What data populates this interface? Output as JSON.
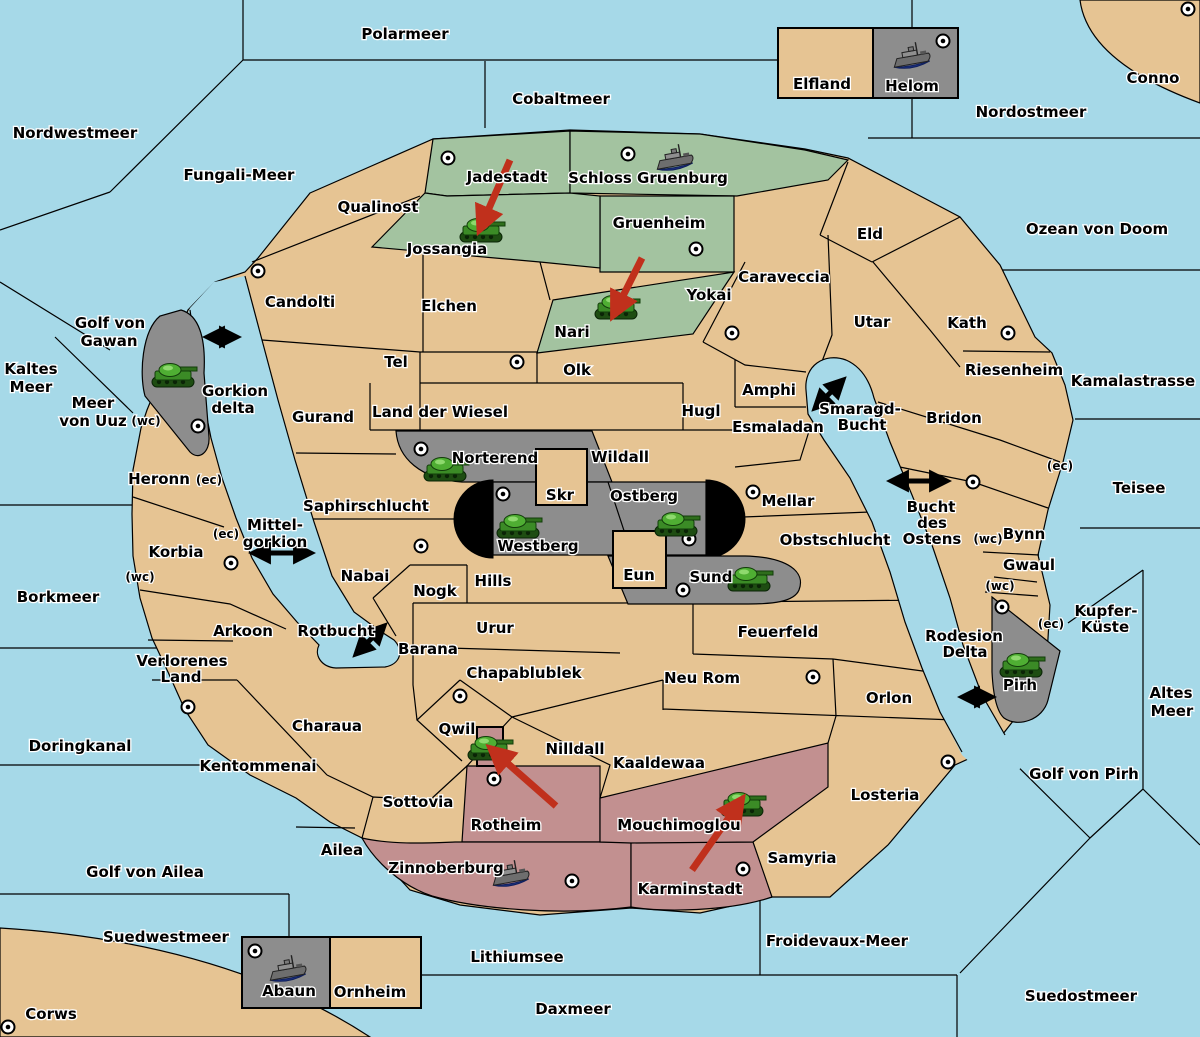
{
  "colors": {
    "sea": "#A6D9E8",
    "land": "#E6C493",
    "green": "#A3C3A0",
    "gray": "#8D8D8D",
    "pink": "#C29090",
    "mountain_black": "#000000",
    "attack_arrow_red": "#C0301C",
    "border": "#000000"
  },
  "sea_labels": [
    {
      "text": "Polarmeer",
      "x": 405,
      "y": 39
    },
    {
      "text": "Cobaltmeer",
      "x": 561,
      "y": 104
    },
    {
      "text": "Nordwestmeer",
      "x": 75,
      "y": 138
    },
    {
      "text": "Fungali-Meer",
      "x": 239,
      "y": 180
    },
    {
      "text": "Nordostmeer",
      "x": 1031,
      "y": 117
    },
    {
      "text": "Ozean von Doom",
      "x": 1097,
      "y": 234
    },
    {
      "text": "Kamalastrasse",
      "x": 1133,
      "y": 386
    },
    {
      "text": "Kaltes",
      "x": 31,
      "y": 374
    },
    {
      "text": "Meer",
      "x": 31,
      "y": 392
    },
    {
      "text": "Golf von",
      "x": 110,
      "y": 328
    },
    {
      "text": "Gawan",
      "x": 109,
      "y": 346
    },
    {
      "text": "Meer",
      "x": 93,
      "y": 408
    },
    {
      "text": "von Uuz",
      "x": 93,
      "y": 426
    },
    {
      "text": "Gorkion",
      "x": 235,
      "y": 396
    },
    {
      "text": "delta",
      "x": 233,
      "y": 413
    },
    {
      "text": "Mittel-",
      "x": 275,
      "y": 530
    },
    {
      "text": "gorkion",
      "x": 275,
      "y": 547
    },
    {
      "text": "Borkmeer",
      "x": 58,
      "y": 602
    },
    {
      "text": "Doringkanal",
      "x": 80,
      "y": 751
    },
    {
      "text": "Golf von Ailea",
      "x": 145,
      "y": 877
    },
    {
      "text": "Suedwestmeer",
      "x": 166,
      "y": 942
    },
    {
      "text": "Corws",
      "x": 51,
      "y": 1019
    },
    {
      "text": "Lithiumsee",
      "x": 517,
      "y": 962
    },
    {
      "text": "Daxmeer",
      "x": 573,
      "y": 1014
    },
    {
      "text": "Froidevaux-Meer",
      "x": 837,
      "y": 946
    },
    {
      "text": "Suedostmeer",
      "x": 1081,
      "y": 1001
    },
    {
      "text": "Golf von Pirh",
      "x": 1084,
      "y": 779
    },
    {
      "text": "Altes",
      "x": 1171,
      "y": 698
    },
    {
      "text": "Meer",
      "x": 1172,
      "y": 716
    },
    {
      "text": "Kupfer-",
      "x": 1106,
      "y": 616
    },
    {
      "text": "Küste",
      "x": 1105,
      "y": 632
    },
    {
      "text": "Teisee",
      "x": 1139,
      "y": 493
    },
    {
      "text": "Smaragd-",
      "x": 860,
      "y": 414
    },
    {
      "text": "Bucht",
      "x": 862,
      "y": 430
    },
    {
      "text": "Bucht",
      "x": 931,
      "y": 512
    },
    {
      "text": "des",
      "x": 932,
      "y": 528
    },
    {
      "text": "Ostens",
      "x": 932,
      "y": 544
    },
    {
      "text": "Rodesion",
      "x": 964,
      "y": 641
    },
    {
      "text": "Delta",
      "x": 965,
      "y": 657
    },
    {
      "text": "Rotbucht",
      "x": 336,
      "y": 636
    }
  ],
  "territory_labels": [
    {
      "text": "Conno",
      "x": 1153,
      "y": 83
    },
    {
      "text": "Elfland",
      "x": 822,
      "y": 89
    },
    {
      "text": "Helom",
      "x": 912,
      "y": 91
    },
    {
      "text": "Qualinost",
      "x": 378,
      "y": 212
    },
    {
      "text": "Candolti",
      "x": 300,
      "y": 307
    },
    {
      "text": "Jadestadt",
      "x": 507,
      "y": 182
    },
    {
      "text": "Schloss Gruenburg",
      "x": 648,
      "y": 183
    },
    {
      "text": "Jossangia",
      "x": 447,
      "y": 254
    },
    {
      "text": "Gruenheim",
      "x": 659,
      "y": 228
    },
    {
      "text": "Elchen",
      "x": 449,
      "y": 311
    },
    {
      "text": "Nari",
      "x": 572,
      "y": 337
    },
    {
      "text": "Olk",
      "x": 577,
      "y": 375
    },
    {
      "text": "Tel",
      "x": 396,
      "y": 367
    },
    {
      "text": "Gurand",
      "x": 323,
      "y": 422
    },
    {
      "text": "Land der Wiesel",
      "x": 440,
      "y": 417
    },
    {
      "text": "Yokai",
      "x": 709,
      "y": 300
    },
    {
      "text": "Caraveccia",
      "x": 784,
      "y": 282
    },
    {
      "text": "Eld",
      "x": 870,
      "y": 239
    },
    {
      "text": "Utar",
      "x": 872,
      "y": 327
    },
    {
      "text": "Kath",
      "x": 967,
      "y": 328
    },
    {
      "text": "Riesenheim",
      "x": 1014,
      "y": 375
    },
    {
      "text": "Bridon",
      "x": 954,
      "y": 423
    },
    {
      "text": "Amphi",
      "x": 769,
      "y": 395
    },
    {
      "text": "Esmaladan",
      "x": 778,
      "y": 432
    },
    {
      "text": "Hugl",
      "x": 701,
      "y": 416
    },
    {
      "text": "Mellar",
      "x": 788,
      "y": 506
    },
    {
      "text": "Obstschlucht",
      "x": 835,
      "y": 545
    },
    {
      "text": "Wildall",
      "x": 620,
      "y": 462
    },
    {
      "text": "Norterend",
      "x": 495,
      "y": 463
    },
    {
      "text": "Skr",
      "x": 560,
      "y": 500
    },
    {
      "text": "Ostberg",
      "x": 644,
      "y": 501
    },
    {
      "text": "Westberg",
      "x": 538,
      "y": 551
    },
    {
      "text": "Eun",
      "x": 639,
      "y": 580
    },
    {
      "text": "Sund",
      "x": 711,
      "y": 582
    },
    {
      "text": "Saphirschlucht",
      "x": 366,
      "y": 511
    },
    {
      "text": "Nabai",
      "x": 365,
      "y": 581
    },
    {
      "text": "Nogk",
      "x": 435,
      "y": 596
    },
    {
      "text": "Hills",
      "x": 493,
      "y": 586
    },
    {
      "text": "Urur",
      "x": 495,
      "y": 633
    },
    {
      "text": "Barana",
      "x": 428,
      "y": 654
    },
    {
      "text": "Arkoon",
      "x": 243,
      "y": 636
    },
    {
      "text": "Verlorenes",
      "x": 182,
      "y": 666
    },
    {
      "text": "Land",
      "x": 181,
      "y": 682
    },
    {
      "text": "Charaua",
      "x": 327,
      "y": 731
    },
    {
      "text": "Kentommenai",
      "x": 258,
      "y": 771
    },
    {
      "text": "Sottovia",
      "x": 418,
      "y": 807
    },
    {
      "text": "Ailea",
      "x": 342,
      "y": 855
    },
    {
      "text": "Chapablublek",
      "x": 524,
      "y": 678
    },
    {
      "text": "Qwil",
      "x": 457,
      "y": 734
    },
    {
      "text": "Nilldall",
      "x": 575,
      "y": 754
    },
    {
      "text": "Kaaldewaa",
      "x": 659,
      "y": 768
    },
    {
      "text": "Neu Rom",
      "x": 702,
      "y": 683
    },
    {
      "text": "Feuerfeld",
      "x": 778,
      "y": 637
    },
    {
      "text": "Orlon",
      "x": 889,
      "y": 703
    },
    {
      "text": "Losteria",
      "x": 885,
      "y": 800
    },
    {
      "text": "Samyria",
      "x": 802,
      "y": 863
    },
    {
      "text": "Mouchimoglou",
      "x": 679,
      "y": 830
    },
    {
      "text": "Karminstadt",
      "x": 690,
      "y": 894
    },
    {
      "text": "Zinnoberburg",
      "x": 446,
      "y": 873
    },
    {
      "text": "Rotheim",
      "x": 506,
      "y": 830
    },
    {
      "text": "Ornheim",
      "x": 370,
      "y": 997
    },
    {
      "text": "Abaun",
      "x": 289,
      "y": 996
    },
    {
      "text": "Heronn",
      "x": 159,
      "y": 484
    },
    {
      "text": "Korbia",
      "x": 176,
      "y": 557
    },
    {
      "text": "Pirh",
      "x": 1020,
      "y": 690
    },
    {
      "text": "Bynn",
      "x": 1024,
      "y": 539
    },
    {
      "text": "Gwaul",
      "x": 1029,
      "y": 570
    }
  ],
  "coast_tags": [
    {
      "text": "(wc)",
      "x": 146,
      "y": 425
    },
    {
      "text": "(ec)",
      "x": 209,
      "y": 484
    },
    {
      "text": "(ec)",
      "x": 226,
      "y": 538
    },
    {
      "text": "(wc)",
      "x": 140,
      "y": 581
    },
    {
      "text": "(ec)",
      "x": 1060,
      "y": 470
    },
    {
      "text": "(wc)",
      "x": 988,
      "y": 543
    },
    {
      "text": "(wc)",
      "x": 1000,
      "y": 590
    },
    {
      "text": "(ec)",
      "x": 1051,
      "y": 628
    }
  ],
  "town_markers": [
    [
      258,
      271
    ],
    [
      448,
      158
    ],
    [
      628,
      154
    ],
    [
      696,
      249
    ],
    [
      1188,
      9
    ],
    [
      943,
      41
    ],
    [
      732,
      333
    ],
    [
      1008,
      333
    ],
    [
      517,
      362
    ],
    [
      421,
      449
    ],
    [
      503,
      494
    ],
    [
      689,
      539
    ],
    [
      683,
      590
    ],
    [
      753,
      492
    ],
    [
      198,
      426
    ],
    [
      231,
      563
    ],
    [
      421,
      546
    ],
    [
      973,
      482
    ],
    [
      1002,
      607
    ],
    [
      188,
      707
    ],
    [
      460,
      696
    ],
    [
      813,
      677
    ],
    [
      494,
      779
    ],
    [
      572,
      881
    ],
    [
      743,
      869
    ],
    [
      948,
      762
    ],
    [
      8,
      1027
    ],
    [
      255,
      951
    ]
  ],
  "tanks": [
    {
      "territory": "Jossangia",
      "x": 481,
      "y": 230
    },
    {
      "territory": "Nari",
      "x": 616,
      "y": 307
    },
    {
      "territory": "Gawar",
      "x": 173,
      "y": 375
    },
    {
      "territory": "Norterend",
      "x": 445,
      "y": 469
    },
    {
      "territory": "Westberg",
      "x": 518,
      "y": 526
    },
    {
      "territory": "Ostberg",
      "x": 676,
      "y": 524
    },
    {
      "territory": "Sund",
      "x": 749,
      "y": 579
    },
    {
      "territory": "Qwil",
      "x": 489,
      "y": 748
    },
    {
      "territory": "Mouchimoglou",
      "x": 742,
      "y": 804
    },
    {
      "territory": "Pirh",
      "x": 1021,
      "y": 665
    }
  ],
  "ships": [
    {
      "territory": "Schloss Gruenburg",
      "x": 675,
      "y": 160
    },
    {
      "territory": "Helom",
      "x": 912,
      "y": 58
    },
    {
      "territory": "Zinnoberburg",
      "x": 511,
      "y": 876
    },
    {
      "territory": "Abaun",
      "x": 288,
      "y": 971
    }
  ],
  "attack_arrows": [
    {
      "x1": 510,
      "y1": 160,
      "x2": 483,
      "y2": 222
    },
    {
      "x1": 642,
      "y1": 258,
      "x2": 617,
      "y2": 308
    },
    {
      "x1": 556,
      "y1": 806,
      "x2": 497,
      "y2": 754
    },
    {
      "x1": 692,
      "y1": 870,
      "x2": 737,
      "y2": 806
    }
  ],
  "transit_arrows": [
    {
      "x": 222,
      "y": 337,
      "len": 24,
      "ang": 0
    },
    {
      "x": 282,
      "y": 553,
      "len": 52,
      "ang": 0
    },
    {
      "x": 370,
      "y": 640,
      "len": 34,
      "ang": -45
    },
    {
      "x": 829,
      "y": 394,
      "len": 34,
      "ang": -45
    },
    {
      "x": 919,
      "y": 481,
      "len": 50,
      "ang": 0
    },
    {
      "x": 977,
      "y": 697,
      "len": 24,
      "ang": 0
    }
  ]
}
